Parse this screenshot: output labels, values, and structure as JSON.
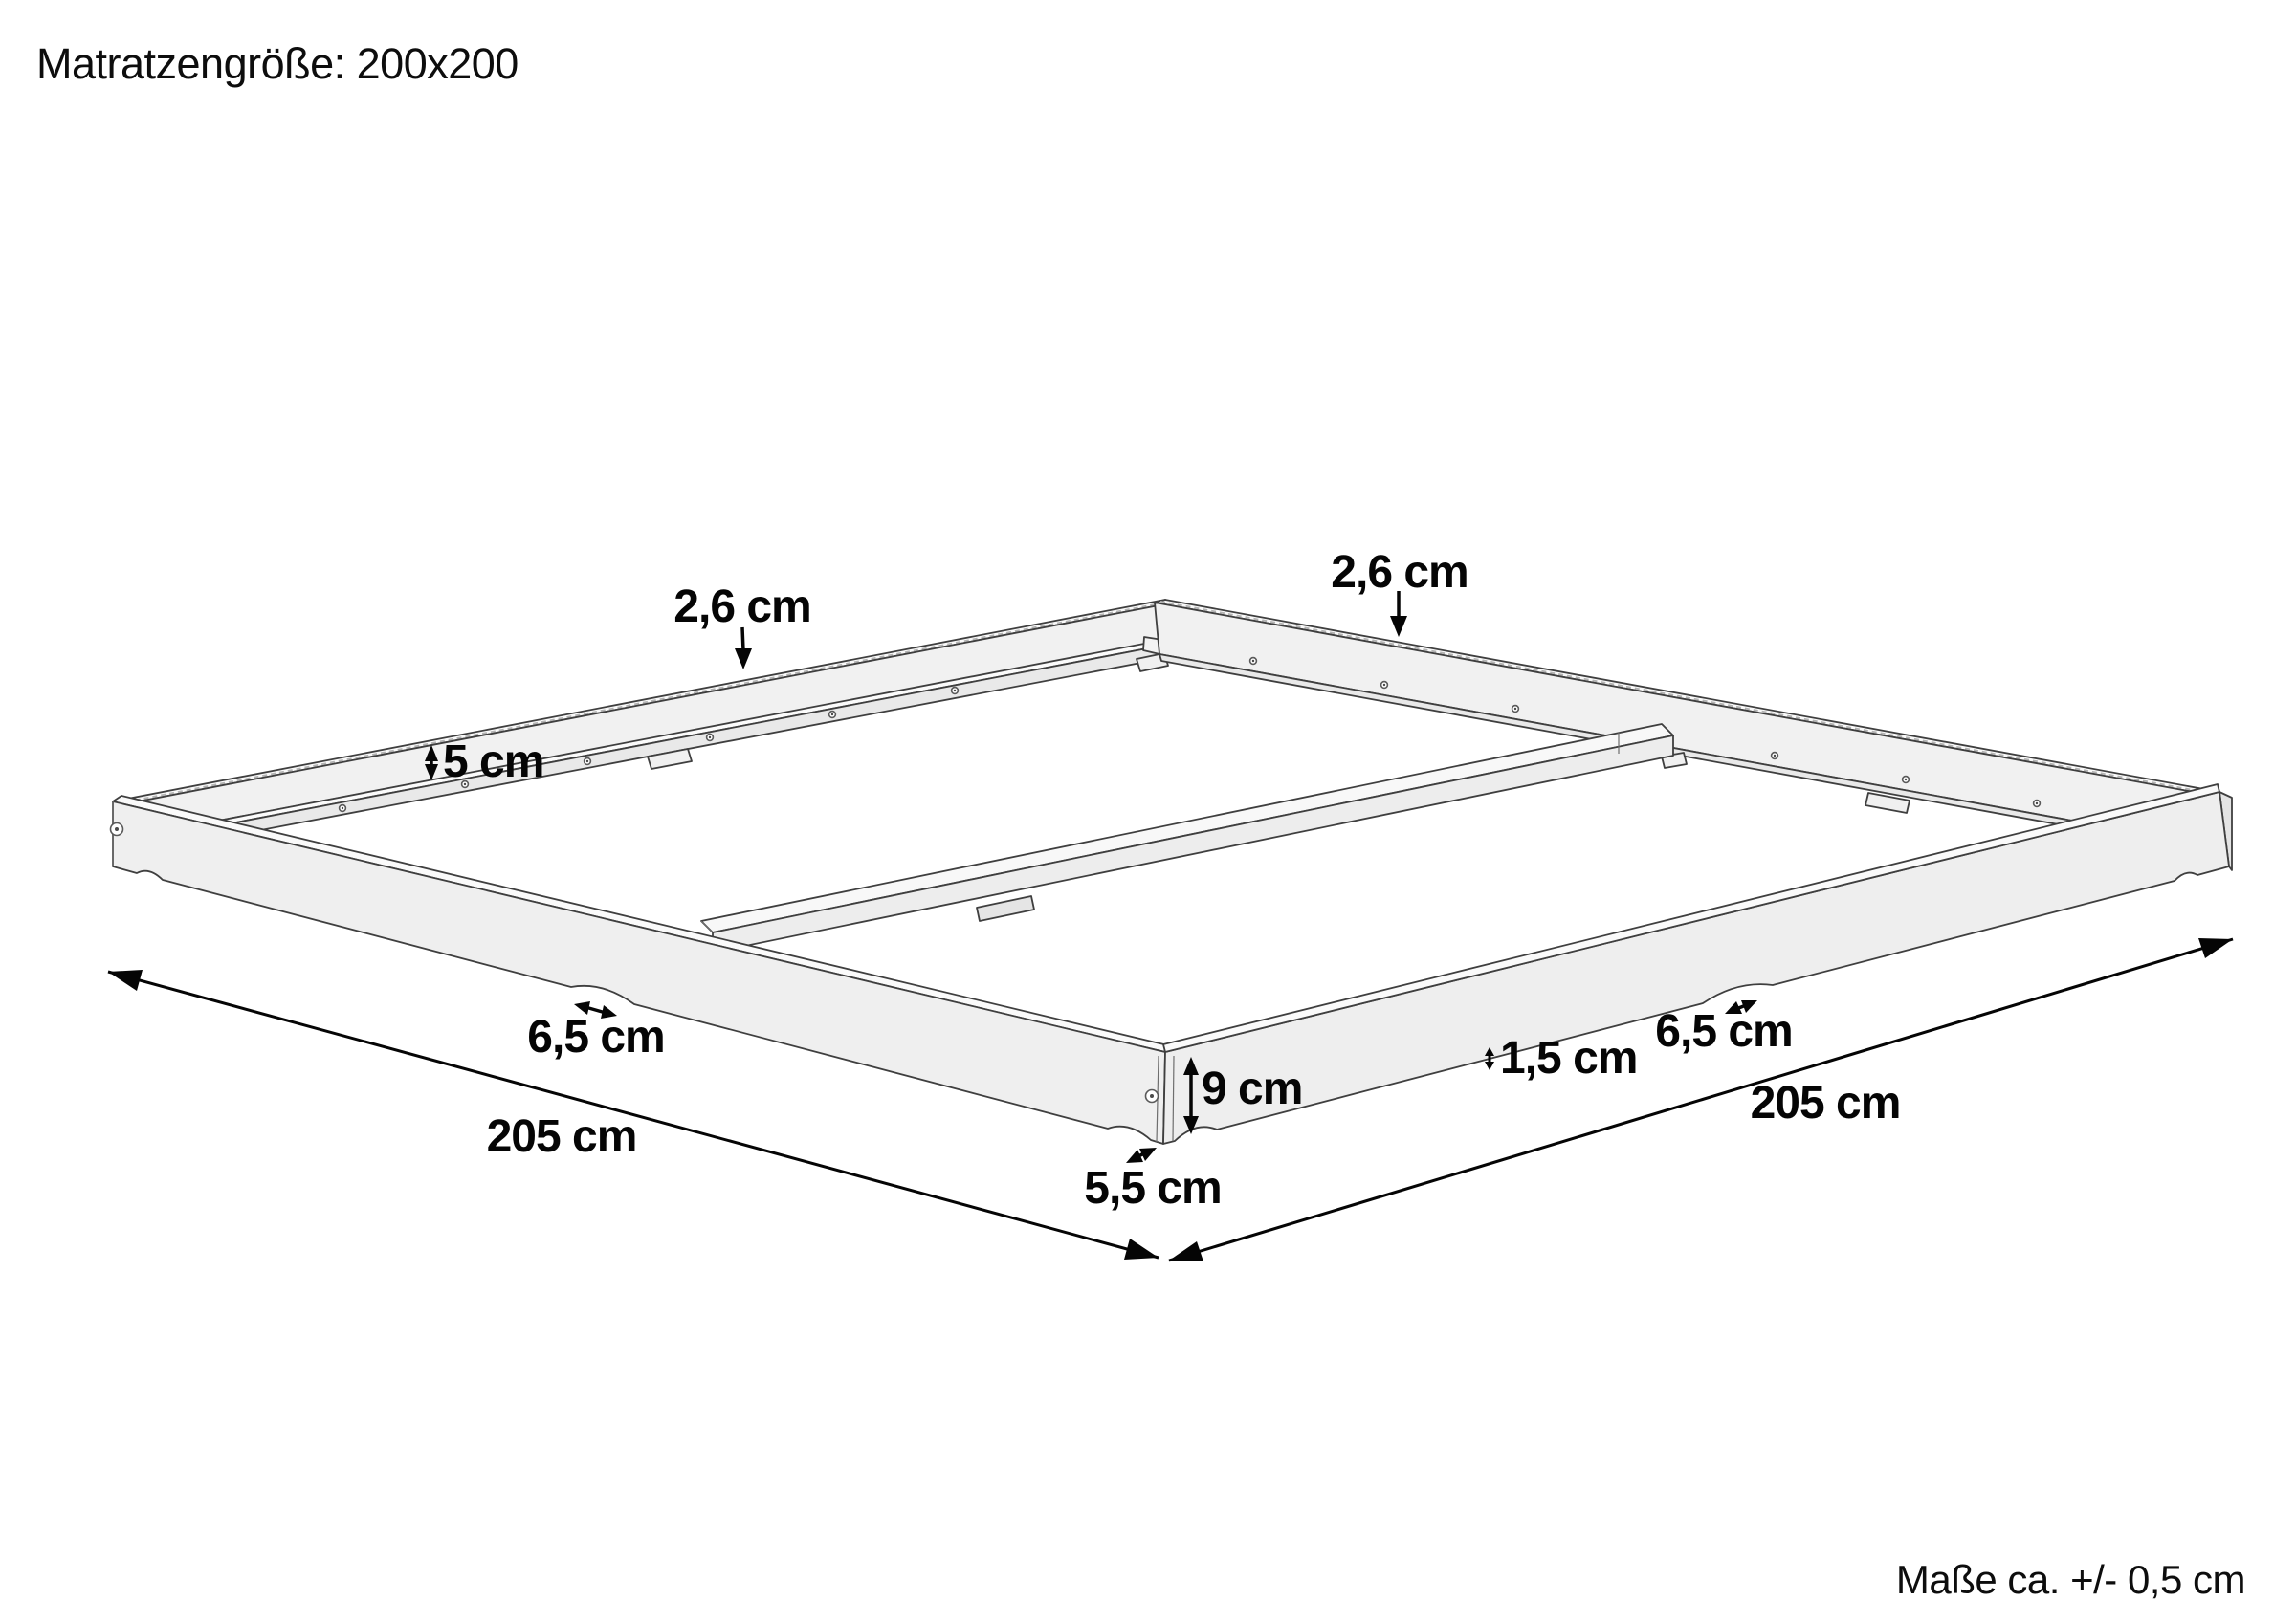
{
  "title": "Matratzengröße: 200x200",
  "footer_note": "Maße ca. +/- 0,5 cm",
  "unit": "cm",
  "colors": {
    "background": "#ffffff",
    "wood_face": "#efefef",
    "wood_face_light": "#f6f6f6",
    "wood_top": "#fafafa",
    "wood_ledge": "#e9e9e9",
    "outline": "#3f3f3f",
    "dimension": "#050505"
  },
  "dimensions": {
    "rail_thickness_back_left": "2,6 cm",
    "rail_thickness_back_right": "2,6 cm",
    "inner_side_height": "5 cm",
    "foot_cutout_left": "6,5 cm",
    "foot_cutout_right": "6,5 cm",
    "outer_length_left": "205 cm",
    "outer_length_right": "205 cm",
    "front_height": "9 cm",
    "bottom_edge_offset": "1,5 cm",
    "corner_foot_width": "5,5 cm"
  }
}
